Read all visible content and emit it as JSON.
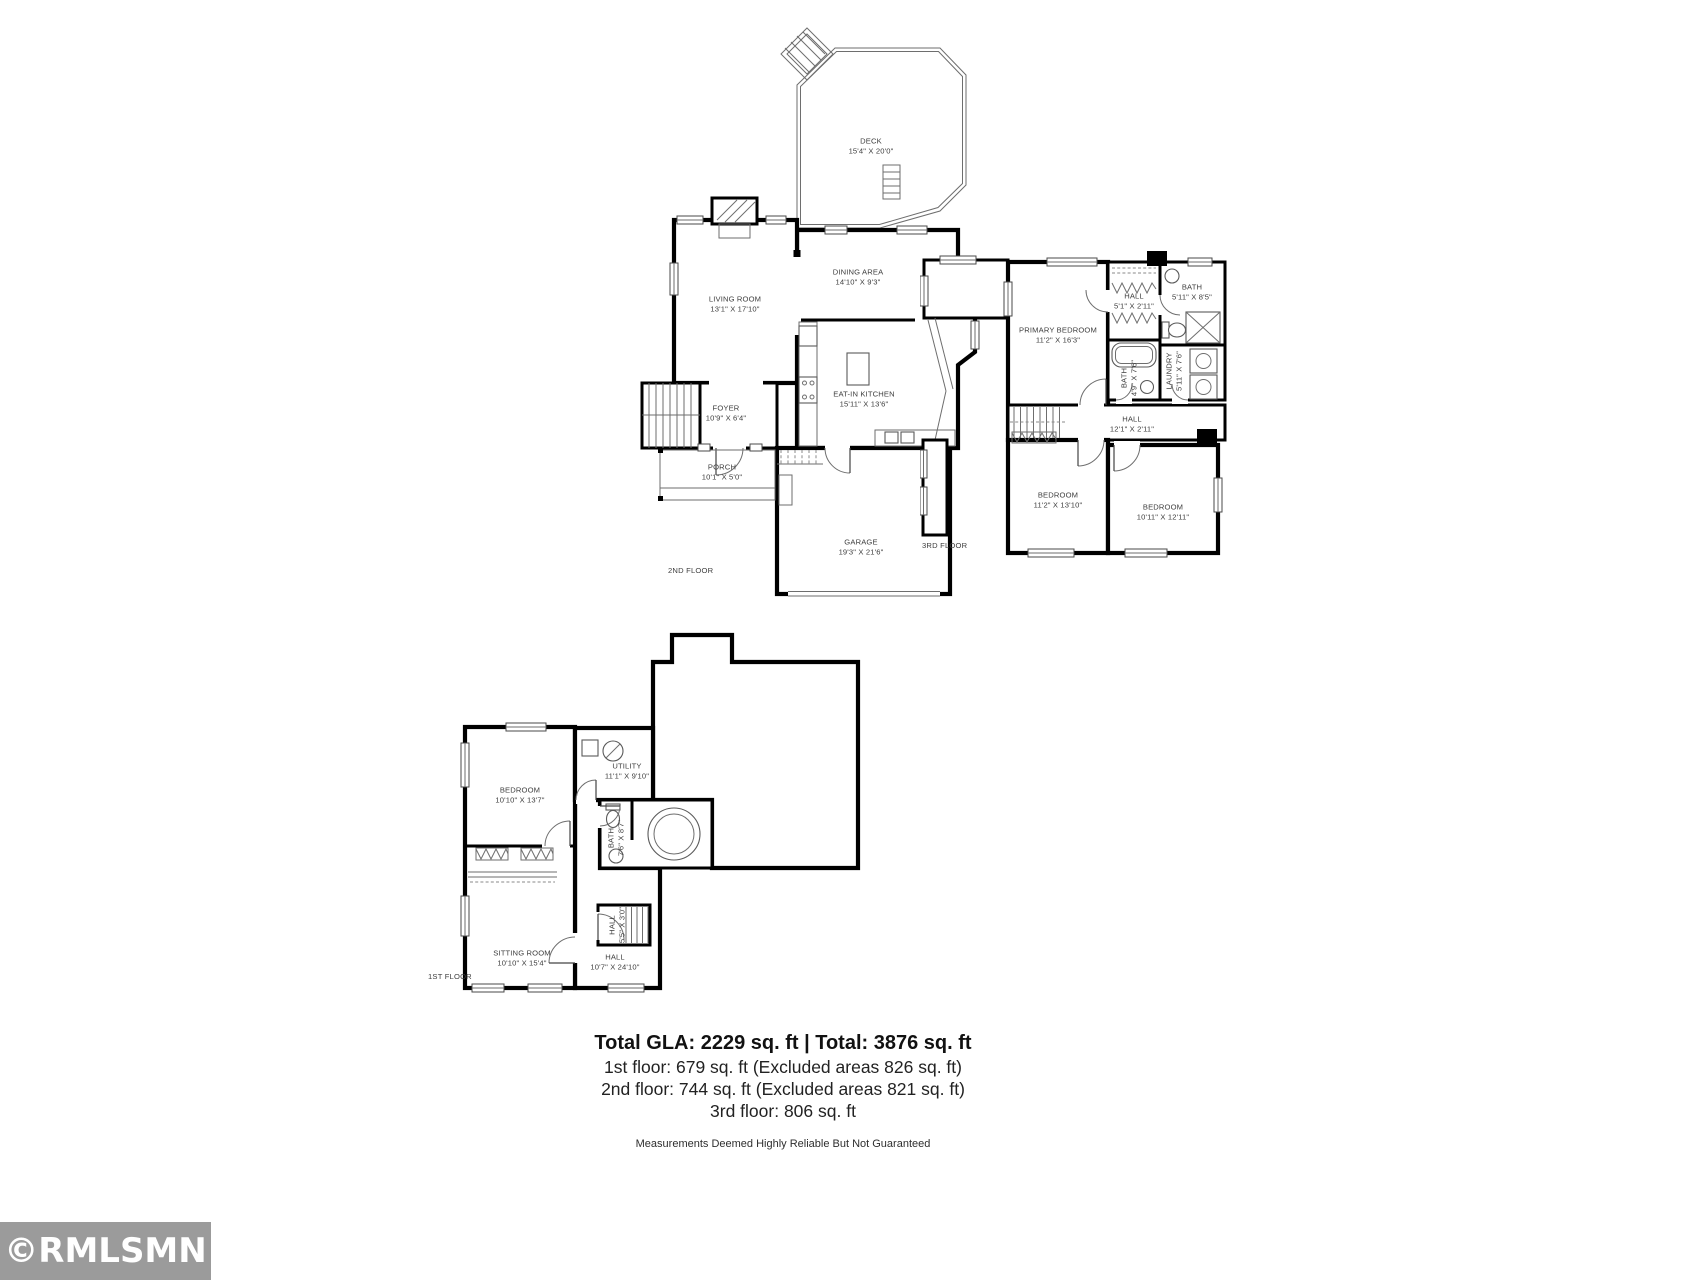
{
  "page": {
    "background": "#ffffff"
  },
  "watermark": {
    "text": "©RMLSMN",
    "bg_color": "#9b9b9b",
    "text_color": "#ffffff"
  },
  "summary": {
    "total_line": "Total GLA: 2229 sq. ft | Total: 3876 sq. ft",
    "floor_lines": [
      "1st floor: 679 sq. ft (Excluded areas 826 sq. ft)",
      "2nd floor: 744 sq. ft (Excluded areas 821 sq. ft)",
      "3rd floor: 806 sq. ft"
    ],
    "disclaimer": "Measurements Deemed Highly Reliable But Not Guaranteed"
  },
  "floors": {
    "second": {
      "label": "2ND FLOOR",
      "rooms": {
        "deck": {
          "name": "DECK",
          "dims": "15'4\" X 20'0\""
        },
        "living_room": {
          "name": "LIVING ROOM",
          "dims": "13'1\" X 17'10\""
        },
        "dining_area": {
          "name": "DINING AREA",
          "dims": "14'10\" X 9'3\""
        },
        "kitchen": {
          "name": "EAT-IN KITCHEN",
          "dims": "15'11\" X 13'6\""
        },
        "foyer": {
          "name": "FOYER",
          "dims": "10'9\" X 6'4\""
        },
        "porch": {
          "name": "PORCH",
          "dims": "10'1\" X 5'0\""
        },
        "garage": {
          "name": "GARAGE",
          "dims": "19'3\" X 21'6\""
        }
      }
    },
    "third": {
      "label": "3RD FLOOR",
      "rooms": {
        "primary_bedroom": {
          "name": "PRIMARY BEDROOM",
          "dims": "11'2\" X 16'3\""
        },
        "hall_upper": {
          "name": "HALL",
          "dims": "5'1\" X 2'11\""
        },
        "bath_right": {
          "name": "BATH",
          "dims": "5'11\" X 8'5\""
        },
        "bath_middle": {
          "name": "BATH",
          "dims": "4'9\" X 7'6\""
        },
        "laundry": {
          "name": "LAUNDRY",
          "dims": "5'11\" X 7'6\""
        },
        "hall_main": {
          "name": "HALL",
          "dims": "12'1\" X 2'11\""
        },
        "bedroom_left": {
          "name": "BEDROOM",
          "dims": "11'2\" X 13'10\""
        },
        "bedroom_right": {
          "name": "BEDROOM",
          "dims": "10'11\" X 12'11\""
        }
      }
    },
    "first": {
      "label": "1ST FLOOR",
      "rooms": {
        "bedroom": {
          "name": "BEDROOM",
          "dims": "10'10\" X 13'7\""
        },
        "utility": {
          "name": "UTILITY",
          "dims": "11'1\" X 9'10\""
        },
        "bath": {
          "name": "BATH",
          "dims": "7'6\" X 8'7\""
        },
        "hall_entry": {
          "name": "HALL",
          "dims": "5'5\" X 3'0\""
        },
        "sitting_room": {
          "name": "SITTING ROOM",
          "dims": "10'10\" X 15'4\""
        },
        "hall": {
          "name": "HALL",
          "dims": "10'7\" X 24'10\""
        }
      }
    }
  }
}
